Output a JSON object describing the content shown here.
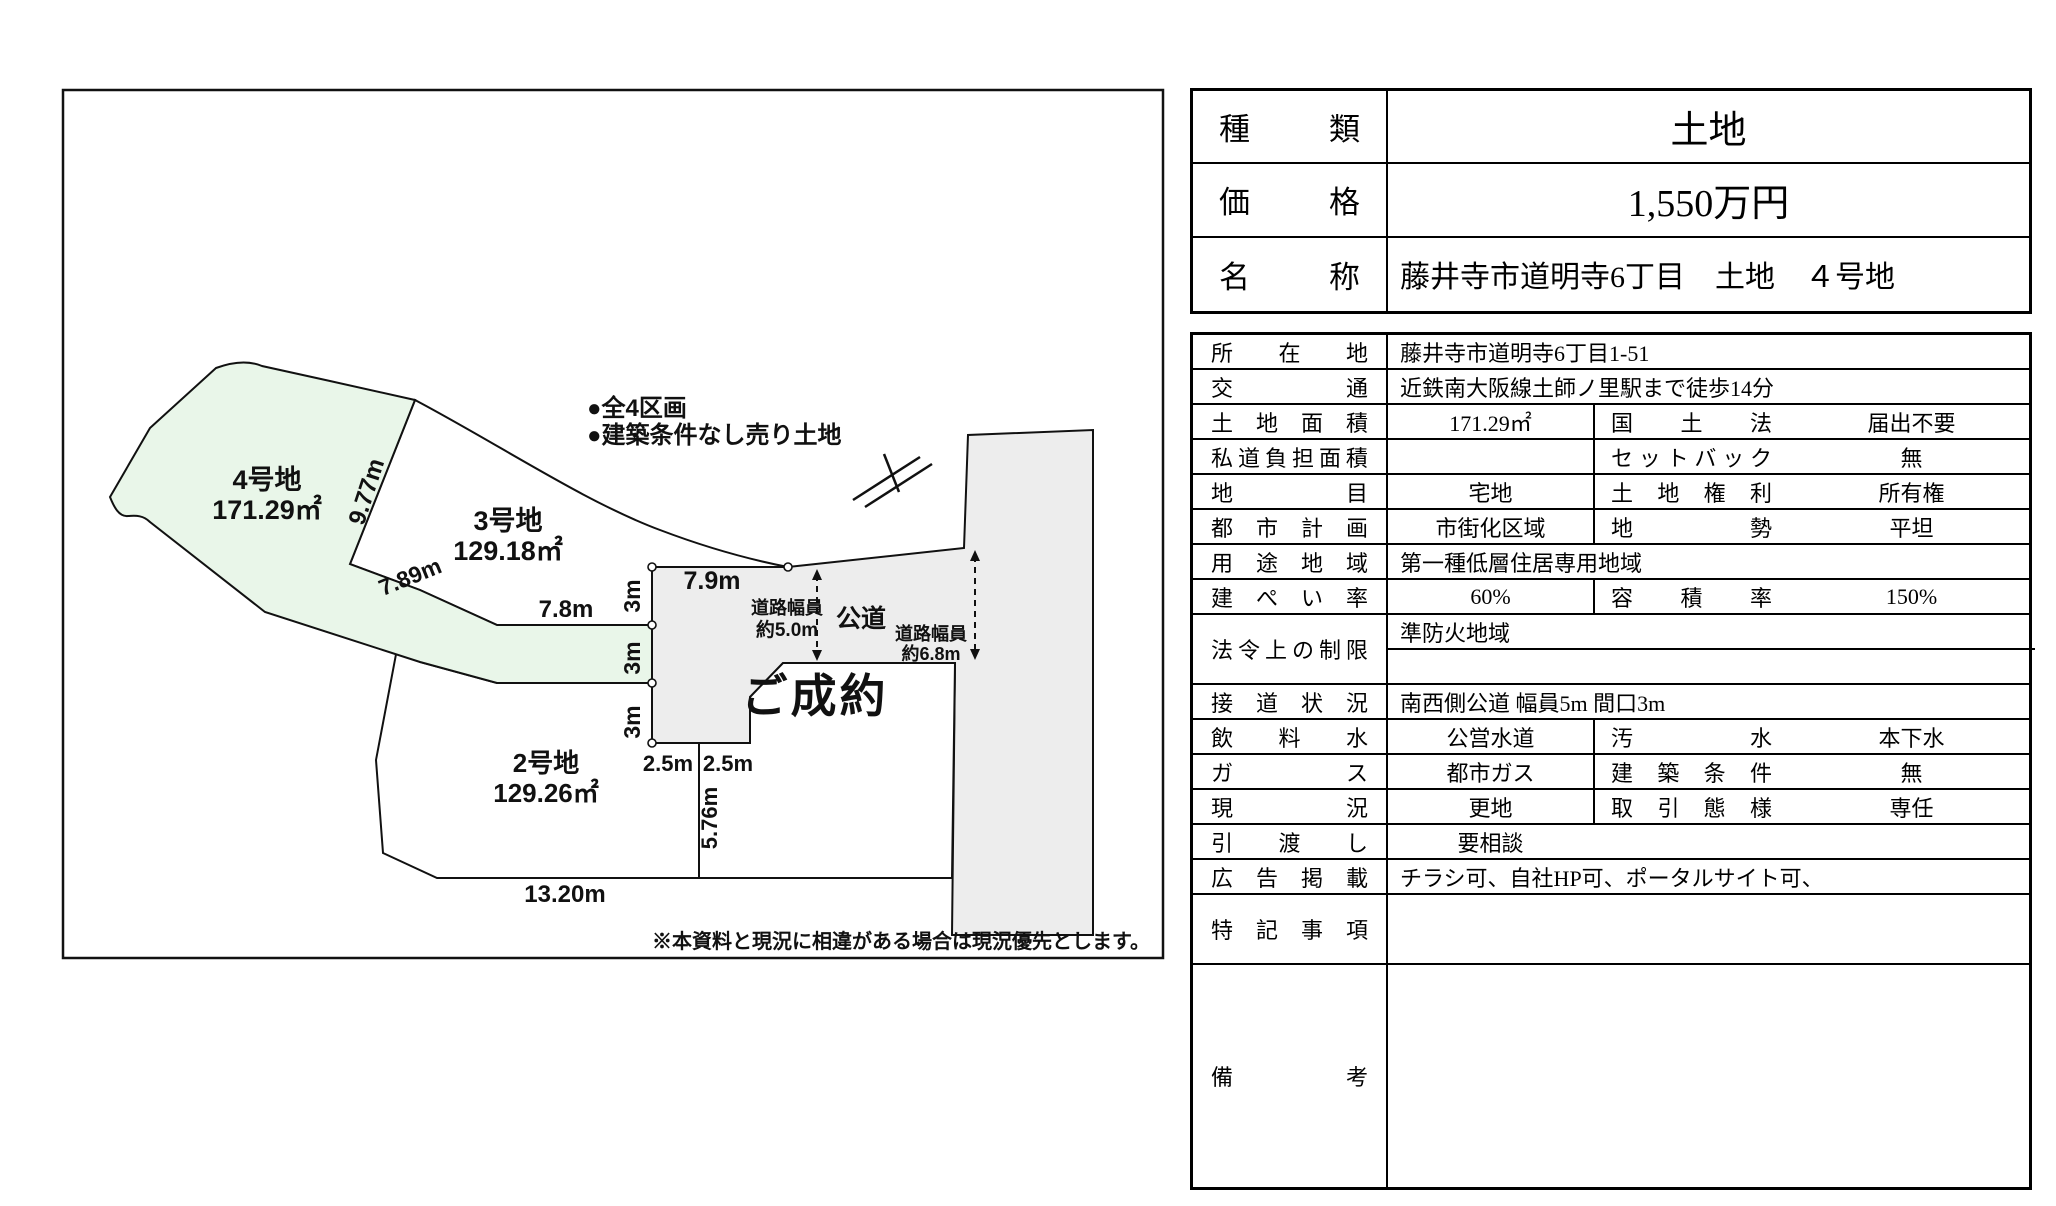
{
  "diagram": {
    "notes": {
      "n1": "●全4区画",
      "n2": "●建築条件なし売り土地"
    },
    "parcels": {
      "lot4_name": "4号地",
      "lot4_area": "171.29㎡",
      "lot3_name": "3号地",
      "lot3_area": "129.18㎡",
      "lot2_name": "2号地",
      "lot2_area": "129.26㎡",
      "sold_label": "ご成約"
    },
    "dims": {
      "d977": "9.77m",
      "d789": "7.89m",
      "d78": "7.8m",
      "d79": "7.9m",
      "d3a": "3m",
      "d3b": "3m",
      "d3c": "3m",
      "d25a": "2.5m",
      "d25b": "2.5m",
      "d576": "5.76m",
      "d1320": "13.20m"
    },
    "roads": {
      "koudou": "公道",
      "w50_line1": "道路幅員",
      "w50_line2": "約5.0m",
      "w68_line1": "道路幅員",
      "w68_line2": "約6.8m"
    },
    "disclaimer": "※本資料と現況に相違がある場合は現況優先とします。",
    "colors": {
      "lot4_fill": "#e9f6e9",
      "road_fill": "#ededed",
      "white": "#ffffff",
      "line": "#111111"
    }
  },
  "summary": {
    "rows": [
      {
        "label": "種類",
        "value": "土地",
        "big": true
      },
      {
        "label": "価格",
        "value": "1,550万円",
        "big": true
      },
      {
        "label": "名称",
        "value": "藤井寺市道明寺6丁目　土地　４号地",
        "big": false
      }
    ]
  },
  "details": {
    "rows": [
      {
        "h": 35,
        "label": "所在地",
        "cells": [
          {
            "text": "藤井寺市道明寺6丁目1-51",
            "span": 3,
            "align": "left"
          }
        ]
      },
      {
        "h": 35,
        "label": "交通",
        "cells": [
          {
            "text": "近鉄南大阪線土師ノ里駅まで徒歩14分",
            "span": 3,
            "align": "left"
          }
        ]
      },
      {
        "h": 35,
        "label": "土地面積",
        "cells": [
          {
            "text": "171.29㎡"
          },
          {
            "text": "国土法",
            "kind": "label"
          },
          {
            "text": "届出不要"
          }
        ]
      },
      {
        "h": 35,
        "label": "私道負担面積",
        "cells": [
          {
            "text": ""
          },
          {
            "text": "セットバック",
            "kind": "label"
          },
          {
            "text": "無"
          }
        ]
      },
      {
        "h": 35,
        "label": "地目",
        "cells": [
          {
            "text": "宅地"
          },
          {
            "text": "土地権利",
            "kind": "label"
          },
          {
            "text": "所有権"
          }
        ]
      },
      {
        "h": 35,
        "label": "都市計画",
        "cells": [
          {
            "text": "市街化区域"
          },
          {
            "text": "地勢",
            "kind": "label"
          },
          {
            "text": "平坦"
          }
        ]
      },
      {
        "h": 35,
        "label": "用途地域",
        "cells": [
          {
            "text": "第一種低層住居専用地域",
            "span": 3,
            "align": "left"
          }
        ]
      },
      {
        "h": 35,
        "label": "建ぺい率",
        "cells": [
          {
            "text": "60%"
          },
          {
            "text": "容積率",
            "kind": "label"
          },
          {
            "text": "150%"
          }
        ]
      },
      {
        "h": 70,
        "label": "法令上の制限",
        "cells": [
          {
            "stack": [
              "準防火地域",
              ""
            ],
            "span": 3
          }
        ]
      },
      {
        "h": 35,
        "label": "接道状況",
        "cells": [
          {
            "text": "南西側公道 幅員5m 間口3m",
            "span": 3,
            "align": "left"
          }
        ]
      },
      {
        "h": 35,
        "label": "飲料水",
        "cells": [
          {
            "text": "公営水道"
          },
          {
            "text": "汚水",
            "kind": "label"
          },
          {
            "text": "本下水"
          }
        ]
      },
      {
        "h": 35,
        "label": "ガス",
        "cells": [
          {
            "text": "都市ガス"
          },
          {
            "text": "建築条件",
            "kind": "label"
          },
          {
            "text": "無"
          }
        ]
      },
      {
        "h": 35,
        "label": "現況",
        "cells": [
          {
            "text": "更地"
          },
          {
            "text": "取引態様",
            "kind": "label"
          },
          {
            "text": "専任"
          }
        ]
      },
      {
        "h": 35,
        "label": "引渡し",
        "cells": [
          {
            "text": "要相談",
            "span": 3,
            "align": "center-first"
          }
        ]
      },
      {
        "h": 35,
        "label": "広告掲載",
        "cells": [
          {
            "text": "チラシ可、自社HP可、ポータルサイト可、",
            "span": 3,
            "align": "left"
          }
        ]
      },
      {
        "h": 70,
        "label": "特記事項",
        "cells": [
          {
            "text": "",
            "span": 3,
            "align": "left"
          }
        ]
      },
      {
        "h": 222,
        "label": "備考",
        "cells": [
          {
            "text": "",
            "span": 3,
            "align": "left"
          }
        ]
      }
    ]
  }
}
